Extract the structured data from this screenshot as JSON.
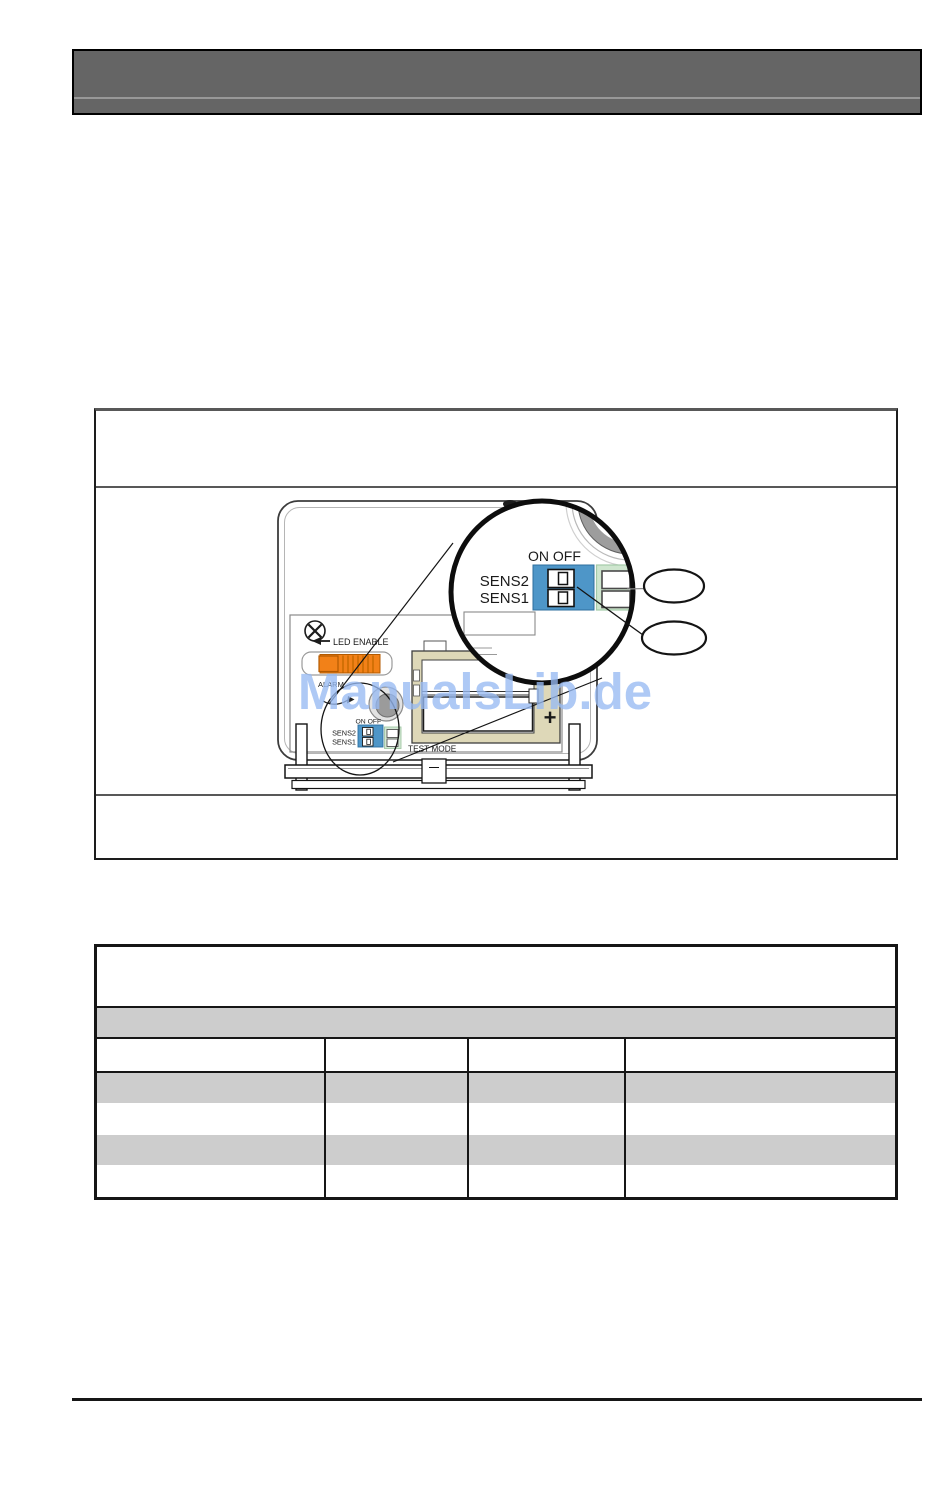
{
  "page": {
    "watermark": "ManualsLib.de"
  },
  "diagram": {
    "magnifier": {
      "on_off_label": "ON OFF",
      "sens2_label": "SENS2",
      "sens1_label": "SENS1"
    },
    "device": {
      "led_enable_label": "LED ENABLE",
      "alarm_label": "ALARM",
      "test_mode_label": "TEST MODE",
      "battery_plus_label": "+",
      "dip": {
        "on_off_label": "ON OFF",
        "sens2_label": "SENS2",
        "sens1_label": "SENS1"
      }
    },
    "colors": {
      "dip_blue": "#4E96C8",
      "dip_green": "#CFE6CF",
      "slider_orange": "#F28118",
      "battery_tan": "#DED8B8",
      "speaker_gray": "#9D9D9D",
      "watermark_blue": "#97BAF2",
      "header_gray": "#656565",
      "table_row_gray": "#CDCDCD"
    }
  },
  "table": {
    "header_block": "",
    "band": "",
    "columns": [
      "",
      "",
      "",
      ""
    ],
    "rows": [
      [
        "",
        "",
        "",
        ""
      ],
      [
        "",
        "",
        "",
        ""
      ],
      [
        "",
        "",
        "",
        ""
      ],
      [
        "",
        "",
        "",
        ""
      ]
    ]
  }
}
